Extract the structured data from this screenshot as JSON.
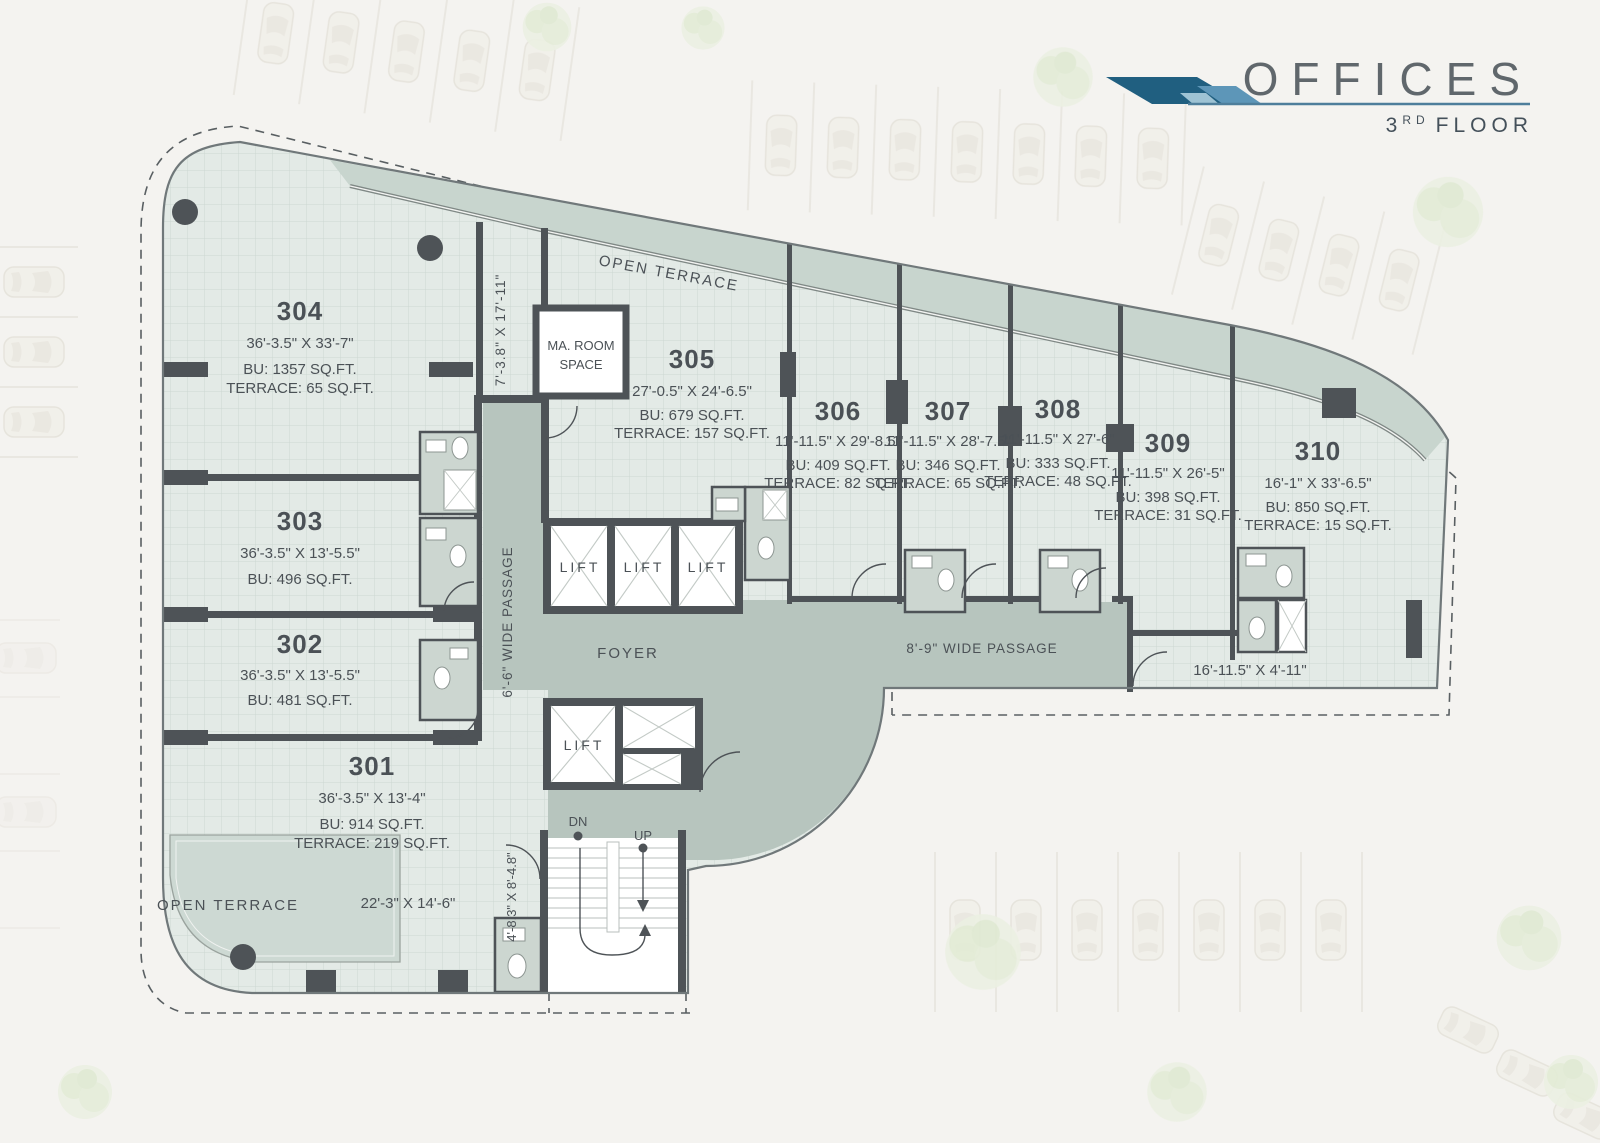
{
  "header": {
    "title": "OFFICES",
    "floor_num": "3",
    "floor_sup": "RD",
    "floor_word": "FLOOR"
  },
  "units": [
    {
      "number": "301",
      "dims": "36'-3.5\" X 13'-4\"",
      "bu": "BU: 914 SQ.FT.",
      "terrace": "TERRACE: 219 SQ.FT."
    },
    {
      "number": "302",
      "dims": "36'-3.5\" X 13'-5.5\"",
      "bu": "BU: 481 SQ.FT.",
      "terrace": ""
    },
    {
      "number": "303",
      "dims": "36'-3.5\" X 13'-5.5\"",
      "bu": "BU: 496 SQ.FT.",
      "terrace": ""
    },
    {
      "number": "304",
      "dims": "36'-3.5\" X 33'-7\"",
      "bu": "BU: 1357 SQ.FT.",
      "terrace": "TERRACE: 65 SQ.FT."
    },
    {
      "number": "305",
      "dims": "27'-0.5\" X 24'-6.5\"",
      "bu": "BU: 679 SQ.FT.",
      "terrace": "TERRACE: 157 SQ.FT."
    },
    {
      "number": "306",
      "dims": "11'-11.5\" X 29'-8.5\"",
      "bu": "BU: 409 SQ.FT.",
      "terrace": "TERRACE: 82 SQ.FT."
    },
    {
      "number": "307",
      "dims": "11'-11.5\" X 28'-7.5\"",
      "bu": "BU: 346 SQ.FT.",
      "terrace": "TERRACE: 65 SQ.FT."
    },
    {
      "number": "308",
      "dims": "11'-11.5\" X 27'-6\"",
      "bu": "BU: 333 SQ.FT.",
      "terrace": "TERRACE: 48 SQ.FT."
    },
    {
      "number": "309",
      "dims": "11'-11.5\" X 26'-5\"",
      "bu": "BU: 398 SQ.FT.",
      "terrace": "TERRACE: 31 SQ.FT."
    },
    {
      "number": "310",
      "dims": "16'-1\" X 33'-6.5\"",
      "bu": "BU: 850 SQ.FT.",
      "terrace": "TERRACE: 15 SQ.FT."
    }
  ],
  "labels": {
    "open_terrace": "OPEN TERRACE",
    "ma_room_1": "MA. ROOM",
    "ma_room_2": "SPACE",
    "lift": "LIFT",
    "foyer": "FOYER",
    "passage_v": "6'-6\" WIDE PASSAGE",
    "passage_h": "8'-9\" WIDE PASSAGE",
    "dim_right_strip": "16'-11.5\" X 4'-11\"",
    "dim_entry": "22'-3\" X 14'-6\"",
    "dim_niche": "7'-3.8\" X 17'-11\"",
    "dim_lobby": "4'-8.3\" X 8'-4.8\"",
    "dn": "DN",
    "up": "UP"
  },
  "colors": {
    "background": "#f4f3f0",
    "floor": "#e3eae6",
    "grid_line": "#ccd8d2",
    "corridor": "#b7c5be",
    "terrace_band": "#c8d5ce",
    "wall": "#4e5357",
    "text": "#4b5156",
    "logo_dark": "#205f80",
    "logo_light": "#5d96b8",
    "header_line": "#4e7e9b"
  }
}
